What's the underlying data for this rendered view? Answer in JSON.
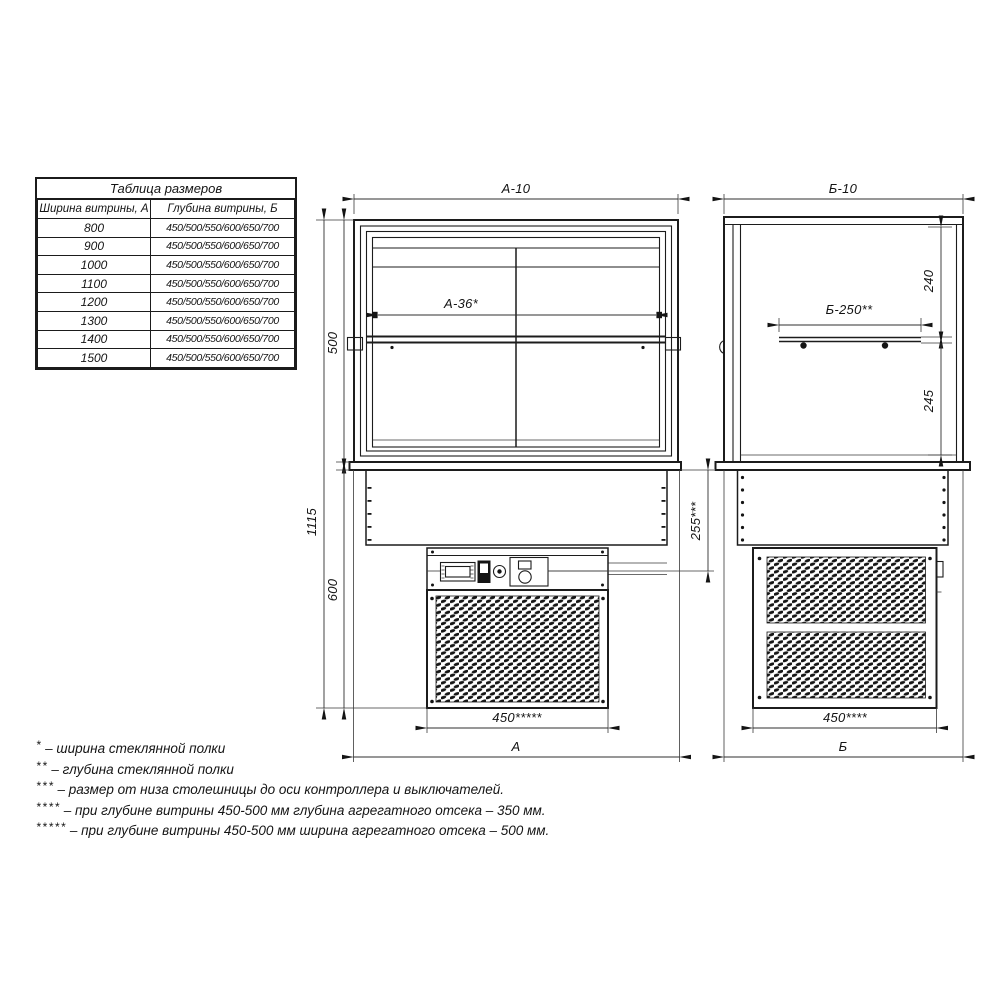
{
  "dimension_table": {
    "title": "Таблица размеров",
    "col_width": "Ширина витрины, А",
    "col_depth": "Глубина витрины, Б",
    "rows": [
      {
        "width": "800",
        "depth": "450/500/550/600/650/700"
      },
      {
        "width": "900",
        "depth": "450/500/550/600/650/700"
      },
      {
        "width": "1000",
        "depth": "450/500/550/600/650/700"
      },
      {
        "width": "1100",
        "depth": "450/500/550/600/650/700"
      },
      {
        "width": "1200",
        "depth": "450/500/550/600/650/700"
      },
      {
        "width": "1300",
        "depth": "450/500/550/600/650/700"
      },
      {
        "width": "1400",
        "depth": "450/500/550/600/650/700"
      },
      {
        "width": "1500",
        "depth": "450/500/550/600/650/700"
      }
    ]
  },
  "front_view": {
    "width_top": "А-10",
    "shelf_width": "А-36*",
    "height_total": "1115",
    "height_glass": "500",
    "height_base": "600",
    "controls_axis": "255***",
    "unit_width": "450*****",
    "width_overall": "А"
  },
  "side_view": {
    "depth_top": "Б-10",
    "shelf_depth": "Б-250**",
    "shelf_to_top": "240",
    "shelf_to_counter": "245",
    "unit_depth": "450****",
    "depth_overall": "Б"
  },
  "footnotes": [
    {
      "marker": "*",
      "text": "– ширина стеклянной полки"
    },
    {
      "marker": "**",
      "text": "– глубина стеклянной полки"
    },
    {
      "marker": "***",
      "text": "– размер от низа столешницы до оси контроллера и выключателей."
    },
    {
      "marker": "****",
      "text": "– при глубине витрины 450-500 мм глубина агрегатного отсека – 350 мм."
    },
    {
      "marker": "*****",
      "text": "– при глубине витрины 450-500 мм ширина агрегатного отсека – 500 мм."
    }
  ],
  "colors": {
    "line": "#1c1c1c",
    "background": "#ffffff"
  }
}
